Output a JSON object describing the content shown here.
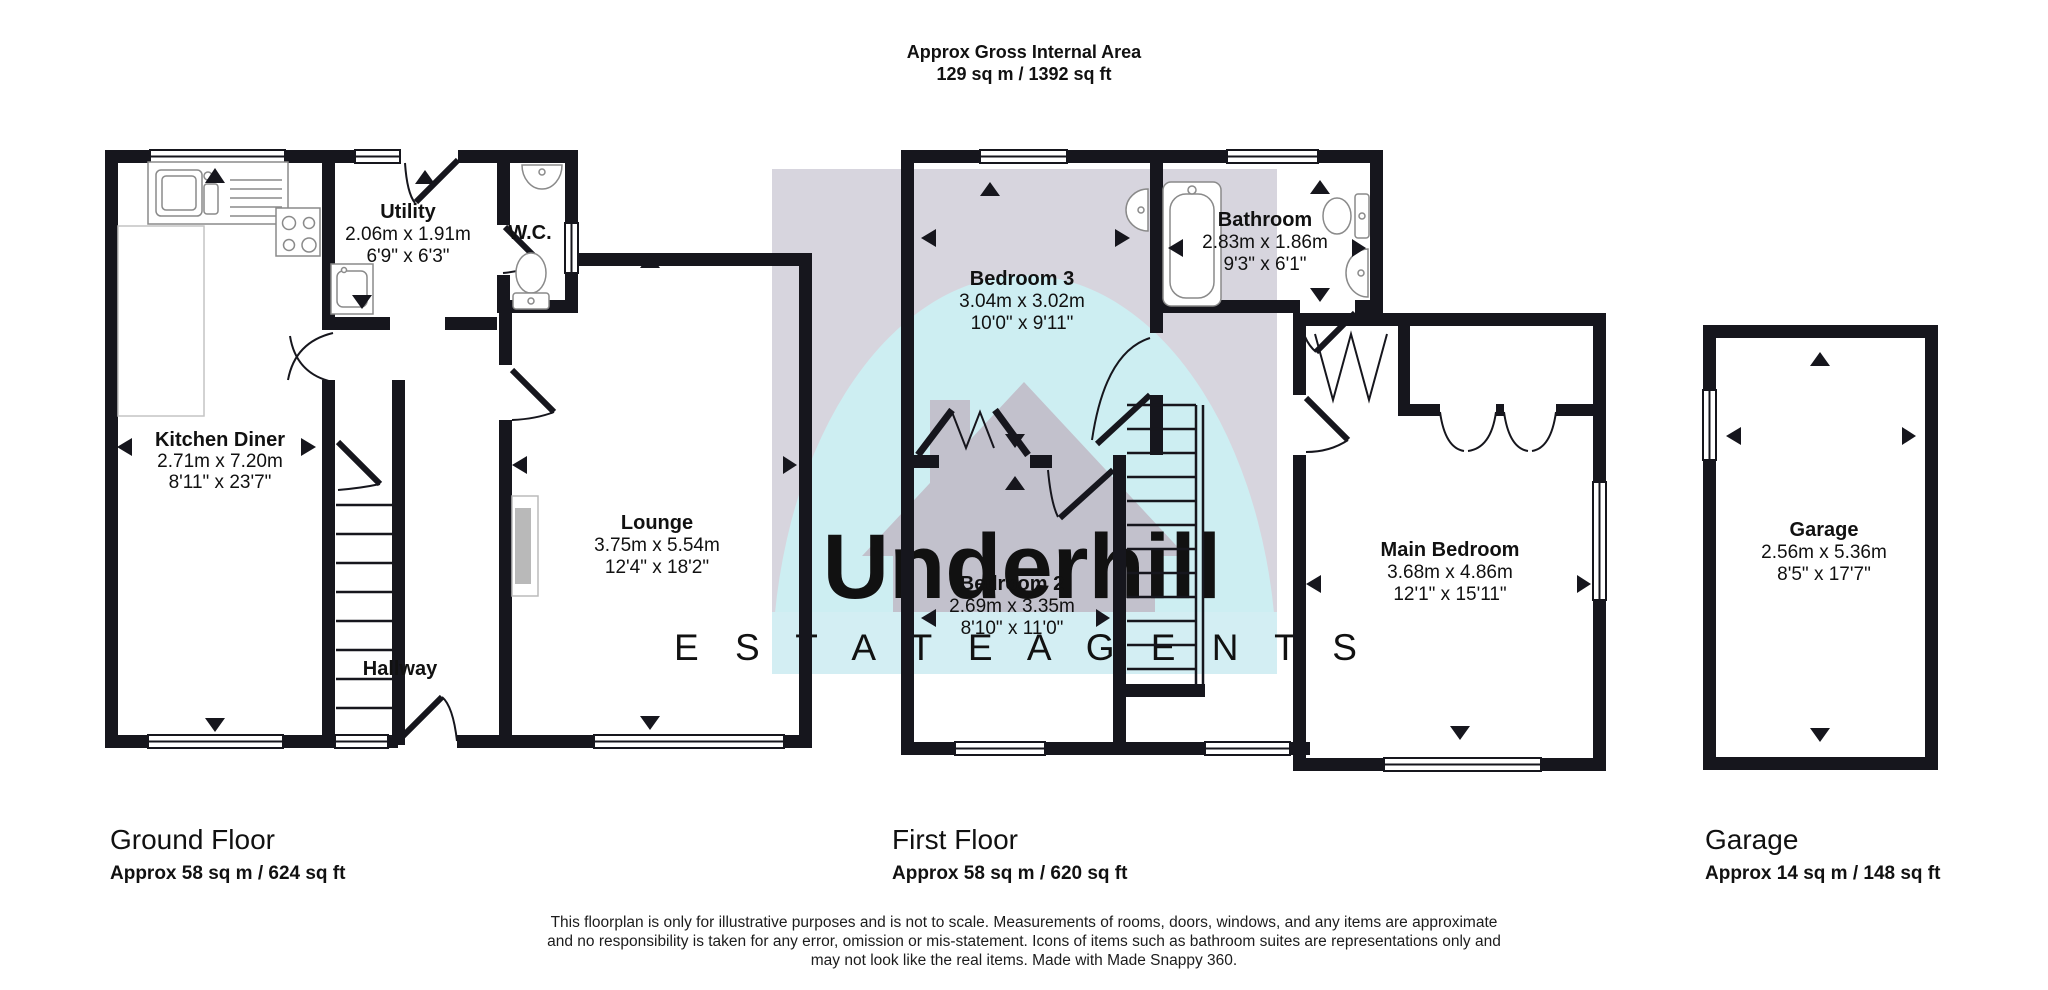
{
  "header": {
    "title": "Approx Gross Internal Area",
    "area": "129 sq m / 1392 sq ft"
  },
  "watermark": {
    "brand": "Underhill",
    "tagline": "E S T A T E   A G E N T S",
    "square_color": "#d7d5de",
    "arch_color": "#cdeef2",
    "house_color": "#c2c1cc",
    "band_color": "#d3eef3",
    "brand_color": "#ffffff",
    "tagline_color": "#e9dce0"
  },
  "colors": {
    "wall": "#16161d",
    "fixture": "#8a8a8a"
  },
  "rooms": {
    "kitchen_diner": {
      "name": "Kitchen Diner",
      "metric": "2.71m x 7.20m",
      "imperial": "8'11\" x 23'7\""
    },
    "utility": {
      "name": "Utility",
      "metric": "2.06m x 1.91m",
      "imperial": "6'9\" x 6'3\""
    },
    "wc": {
      "name": "W.C."
    },
    "lounge": {
      "name": "Lounge",
      "metric": "3.75m x 5.54m",
      "imperial": "12'4\" x 18'2\""
    },
    "hallway": {
      "name": "Hallway"
    },
    "bedroom3": {
      "name": "Bedroom 3",
      "metric": "3.04m x 3.02m",
      "imperial": "10'0\" x 9'11\""
    },
    "bathroom": {
      "name": "Bathroom",
      "metric": "2.83m x 1.86m",
      "imperial": "9'3\" x 6'1\""
    },
    "bedroom2": {
      "name": "Bedroom 2",
      "metric": "2.69m x 3.35m",
      "imperial": "8'10\" x 11'0\""
    },
    "main_bedroom": {
      "name": "Main Bedroom",
      "metric": "3.68m x 4.86m",
      "imperial": "12'1\" x 15'11\""
    },
    "garage": {
      "name": "Garage",
      "metric": "2.56m x 5.36m",
      "imperial": "8'5\" x 17'7\""
    }
  },
  "floors": [
    {
      "name": "Ground Floor",
      "area": "Approx 58 sq m / 624 sq ft"
    },
    {
      "name": "First Floor",
      "area": "Approx 58 sq m / 620 sq ft"
    },
    {
      "name": "Garage",
      "area": "Approx 14 sq m / 148 sq ft"
    }
  ],
  "disclaimer": {
    "l1": "This floorplan is only for illustrative purposes and is not to scale. Measurements of rooms, doors, windows, and any items are approximate",
    "l2": "and no responsibility is taken for any error, omission or mis-statement. Icons of items such as bathroom suites are representations only and",
    "l3": "may not look like the real items. Made with Made Snappy 360."
  }
}
